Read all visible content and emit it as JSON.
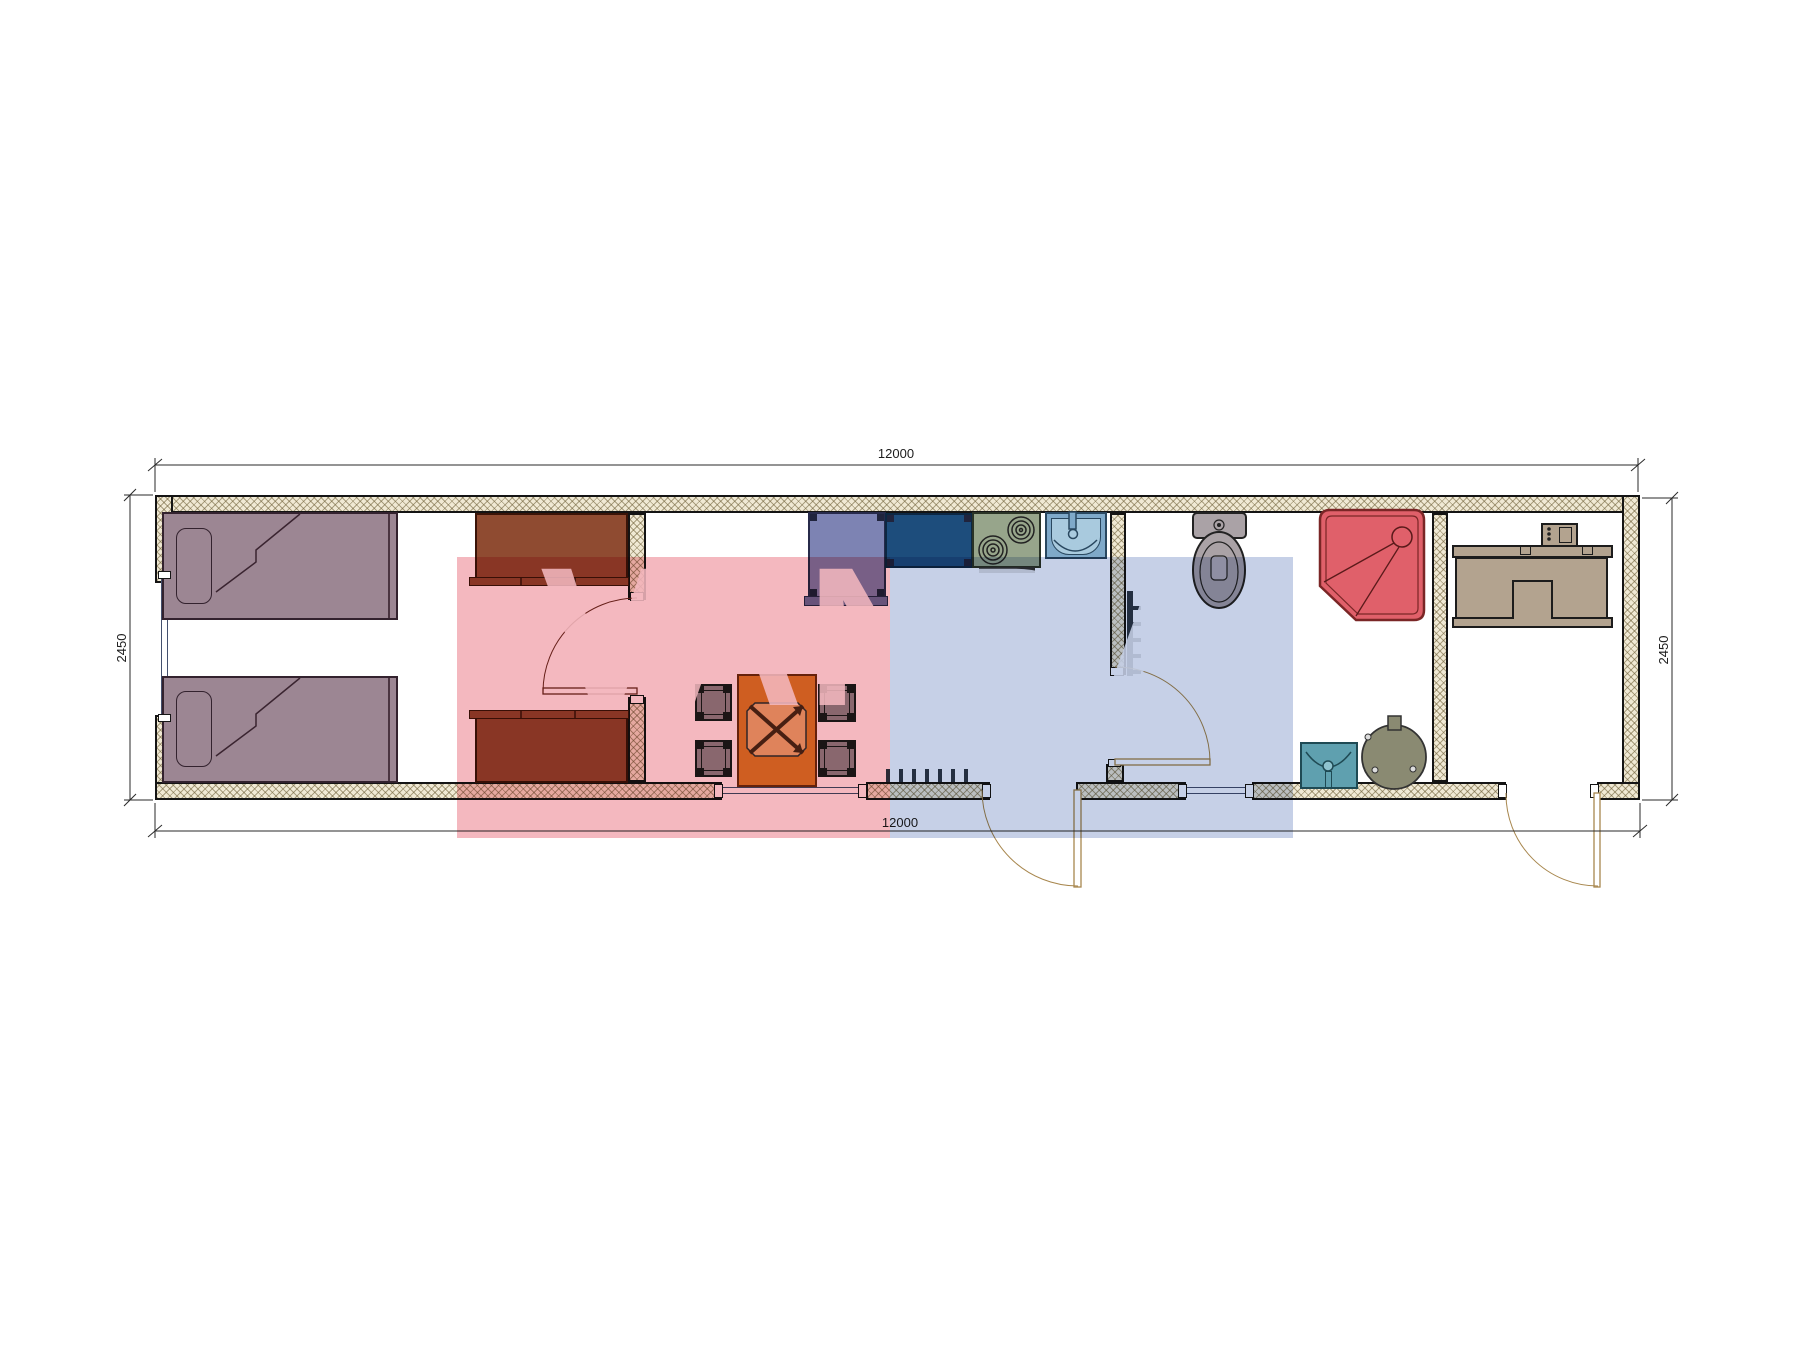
{
  "title": "container-house-floor-plan",
  "dimensions": {
    "top": "12000",
    "bottom": "12000",
    "left": "2450",
    "right": "2450"
  },
  "watermark": {
    "text": "VANDA",
    "red_block_color": "#e03042",
    "blue_block_color": "#4e6cb4",
    "letter_color": "#ffffff"
  },
  "palette": {
    "wall_hatch": "#f0e9d4",
    "bed": "#9c8693",
    "cabinet": "#8f4b31",
    "table": "#d9822b",
    "chair": "#8f8f93",
    "sofa_unit": "#7d83b3",
    "counter": "#1d4d7c",
    "stove": "#97a58b",
    "kitchen_sink": "#7fa9c9",
    "toilet": "#aaa2a6",
    "shower": "#e0606a",
    "bath_sink": "#5fa0af",
    "boiler": "#8a8a72",
    "desk": "#b3a38f"
  }
}
